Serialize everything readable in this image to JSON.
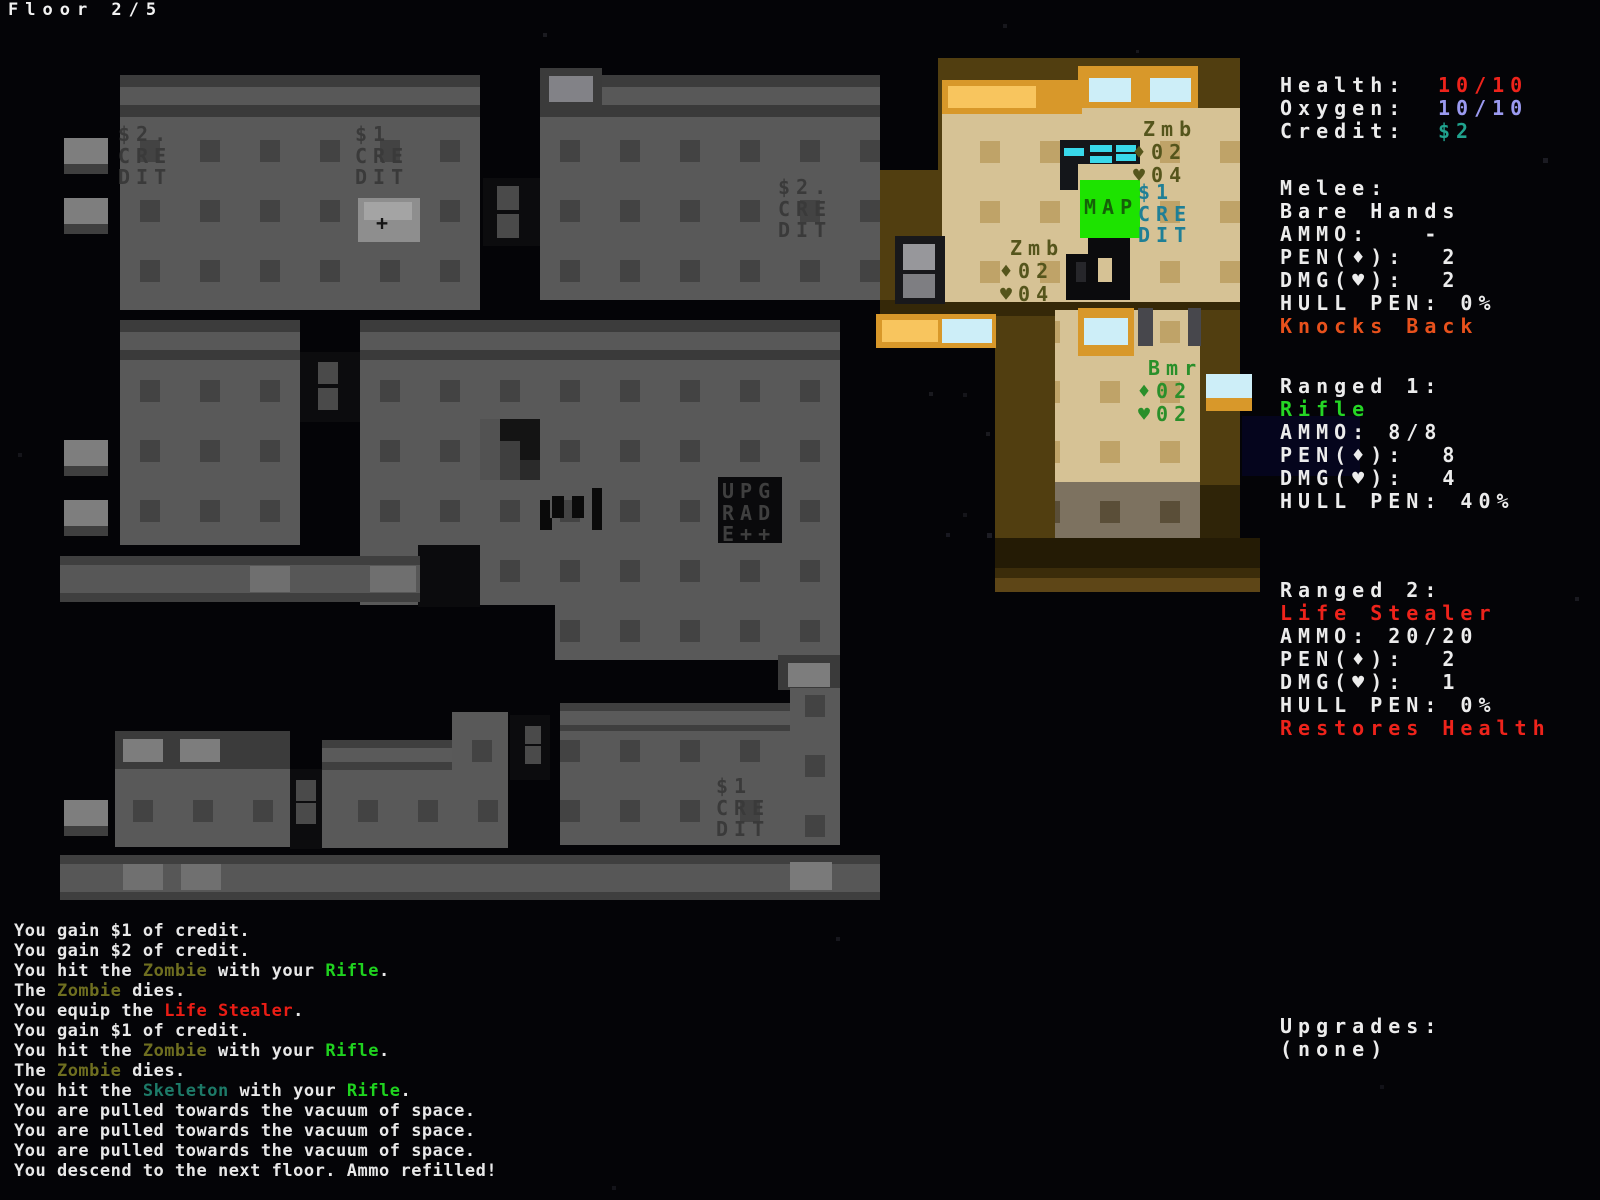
{
  "header": {
    "floor_label": "Floor 2/5"
  },
  "stats": [
    {
      "name": "health-stat",
      "label": "Health:",
      "value": "10/10",
      "color": "#ee231b"
    },
    {
      "name": "oxygen-stat",
      "label": "Oxygen:",
      "value": "10/10",
      "color": "#9b9af0"
    },
    {
      "name": "credit-stat",
      "label": "Credit:",
      "value": "$2",
      "color": "#20a38e"
    }
  ],
  "weapons": [
    {
      "name": "melee-weapon",
      "slot": "Melee:",
      "weapon_name": "Bare Hands",
      "name_color": "#f0f0f0",
      "lines": [
        "AMMO:   -",
        "PEN(♦):  2",
        "DMG(♥):  2",
        "HULL PEN: 0%"
      ],
      "trait": "Knocks Back",
      "trait_color": "#e8511c"
    },
    {
      "name": "ranged1-weapon",
      "slot": "Ranged 1:",
      "weapon_name": "Rifle",
      "name_color": "#25d625",
      "lines": [
        "AMMO: 8/8",
        "PEN(♦):  8",
        "DMG(♥):  4",
        "HULL PEN: 40%"
      ],
      "trait": "",
      "trait_color": ""
    },
    {
      "name": "ranged2-weapon",
      "slot": "Ranged 2:",
      "weapon_name": "Life Stealer",
      "name_color": "#ee231b",
      "lines": [
        "AMMO: 20/20",
        "PEN(♦):  2",
        "DMG(♥):  1",
        "HULL PEN: 0%"
      ],
      "trait": "Restores Health",
      "trait_color": "#ee231b"
    }
  ],
  "upgrades": {
    "title": "Upgrades:",
    "value": "(none)"
  },
  "map": {
    "labels": [
      {
        "name": "credit-item-2a",
        "x": 118,
        "y": 124,
        "color": "#3a3a3a",
        "lines": [
          "$2.",
          "CRE",
          "DIT"
        ]
      },
      {
        "name": "credit-item-1a",
        "x": 355,
        "y": 124,
        "color": "#3a3a3a",
        "lines": [
          "$1",
          "CRE",
          "DIT"
        ]
      },
      {
        "name": "credit-item-2b",
        "x": 778,
        "y": 177,
        "color": "#3a3a3a",
        "lines": [
          "$2.",
          "CRE",
          "DIT"
        ]
      },
      {
        "name": "upgrade-item",
        "x": 722,
        "y": 481,
        "color": "#3f3f3f",
        "lines": [
          "UPG",
          "RAD",
          "E++"
        ]
      },
      {
        "name": "credit-item-1b",
        "x": 716,
        "y": 776,
        "color": "#3a3a3a",
        "lines": [
          "$1",
          "CRE",
          "DIT"
        ]
      },
      {
        "name": "credit-item-1c",
        "x": 1138,
        "y": 182,
        "color": "#1f7f96",
        "lines": [
          "$1",
          "CRE",
          "DIT"
        ]
      },
      {
        "name": "map-item-label",
        "x": 1084,
        "y": 197,
        "color": "#156108",
        "lines": [
          "MAP"
        ]
      },
      {
        "name": "medkit-plus-item",
        "x": 376,
        "y": 213,
        "color": "#141414",
        "lines": [
          "+"
        ]
      }
    ],
    "entities": [
      {
        "name": "zombie-1",
        "label": "Zmb",
        "pen": "02",
        "hp": "04",
        "x": 1133,
        "y": 118,
        "color": "#55551c"
      },
      {
        "name": "zombie-2",
        "label": "Zmb",
        "pen": "02",
        "hp": "04",
        "x": 1000,
        "y": 237,
        "color": "#55551c"
      },
      {
        "name": "boomer-1",
        "label": "Bmr",
        "pen": "02",
        "hp": "02",
        "x": 1138,
        "y": 357,
        "color": "#2a8f2a"
      }
    ],
    "sprites": {
      "player": "player-character",
      "rifle": "rifle-item",
      "corpse": "corpse-remains",
      "pistol": "pistol-item",
      "vent": "hull-vent",
      "door": "door-tiles",
      "window": "window-glass",
      "airlock": "airlock-door",
      "map_tile": "map-pickup-tile"
    }
  },
  "log": {
    "colors": {
      "zombie": "#6f6f20",
      "rifle": "#1fd31f",
      "lifestealer": "#ea1d15",
      "skeleton": "#1d7a68"
    },
    "lines": [
      [
        {
          "t": "You gain $1 of credit."
        }
      ],
      [
        {
          "t": "You gain $2 of credit."
        }
      ],
      [
        {
          "t": "You hit the "
        },
        {
          "t": "Zombie",
          "c": "zombie"
        },
        {
          "t": " with your "
        },
        {
          "t": "Rifle",
          "c": "rifle"
        },
        {
          "t": "."
        }
      ],
      [
        {
          "t": "The "
        },
        {
          "t": "Zombie",
          "c": "zombie"
        },
        {
          "t": " dies."
        }
      ],
      [
        {
          "t": "You equip the "
        },
        {
          "t": "Life Stealer",
          "c": "lifestealer"
        },
        {
          "t": "."
        }
      ],
      [
        {
          "t": "You gain $1 of credit."
        }
      ],
      [
        {
          "t": "You hit the "
        },
        {
          "t": "Zombie",
          "c": "zombie"
        },
        {
          "t": " with your "
        },
        {
          "t": "Rifle",
          "c": "rifle"
        },
        {
          "t": "."
        }
      ],
      [
        {
          "t": "The "
        },
        {
          "t": "Zombie",
          "c": "zombie"
        },
        {
          "t": " dies."
        }
      ],
      [
        {
          "t": "You hit the "
        },
        {
          "t": "Skeleton",
          "c": "skeleton"
        },
        {
          "t": " with your "
        },
        {
          "t": "Rifle",
          "c": "rifle"
        },
        {
          "t": "."
        }
      ],
      [
        {
          "t": "You are pulled towards the vacuum of space."
        }
      ],
      [
        {
          "t": "You are pulled towards the vacuum of space."
        }
      ],
      [
        {
          "t": "You are pulled towards the vacuum of space."
        }
      ],
      [
        {
          "t": "You descend to the next floor. Ammo refilled!"
        }
      ]
    ]
  }
}
